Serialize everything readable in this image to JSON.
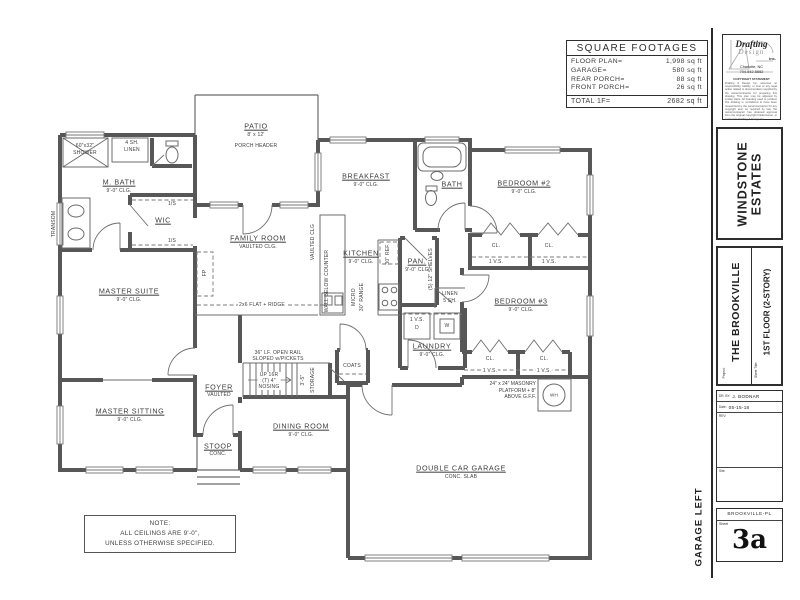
{
  "footages": {
    "title": "SQUARE FOOTAGES",
    "rows": [
      {
        "label": "FLOOR PLAN=",
        "value": "1,998 sq ft"
      },
      {
        "label": "GARAGE=",
        "value": "580 sq ft"
      },
      {
        "label": "REAR PORCH=",
        "value": "88 sq ft"
      },
      {
        "label": "FRONT PORCH=",
        "value": "26 sq ft"
      }
    ],
    "total_label": "TOTAL 1F=",
    "total_value": "2682 sq ft"
  },
  "titleblock": {
    "logo": {
      "name_top": "Drafting",
      "name_mid": "Design",
      "suffix": "Inc.",
      "city": "Charlotte, NC",
      "phone": "704-542-5652",
      "copyright_title": "COPYRIGHT STATEMENT",
      "copyright_text": "Drafting & Design Inc. assumes no responsibility, liability, or cost of any legal action related to documentation supplied by the owner/contractor for preparing this drawing. This plan may be adjusted by similar plans. All branding used to produce this drawing is considered to have been researched by the owner/contractor for any copyright and, as required by law, the owner/contractor has obtained approval from the original copyright holder/owner, or contract to Drafting & Design Inc."
    },
    "subdivision_line1": "WINDSTONE",
    "subdivision_line2": "ESTATES",
    "project_label": "Project:",
    "project_name": "THE BROOKVILLE",
    "sheet_title_label": "Sheet Title:",
    "sheet_title": "1ST FLOOR (2-STORY)",
    "drawn_by_label": "DR. BY:",
    "drawn_by": "J. BODNAR",
    "date_label": "Date:",
    "date_value": "05-15-18",
    "rev_label": "REV:",
    "site_label": "Site:",
    "file_name": "BROOKVILLE-PL",
    "sheet_label": "Sheet",
    "sheet_number": "3a",
    "orientation_note": "GARAGE LEFT"
  },
  "note": {
    "line1": "NOTE:",
    "line2": "ALL CEILINGS ARE 9'-0\",",
    "line3": "UNLESS OTHERWISE SPECIFIED."
  },
  "rooms": {
    "mbath": {
      "name": "M. BATH",
      "clg": "9'-0\" CLG."
    },
    "wic": {
      "name": "WIC"
    },
    "master_suite": {
      "name": "MASTER SUITE",
      "clg": "9'-0\" CLG."
    },
    "master_sitting": {
      "name": "MASTER SITTING",
      "clg": "9'-0\" CLG."
    },
    "patio": {
      "name": "PATIO",
      "size": "8' x 12'",
      "header": "PORCH HEADER"
    },
    "family": {
      "name": "FAMILY ROOM",
      "clg": "VAULTED CLG."
    },
    "breakfast": {
      "name": "BREAKFAST",
      "clg": "9'-0\" CLG."
    },
    "kitchen": {
      "name": "KITCHEN",
      "clg": "9'-0\" CLG."
    },
    "pantry": {
      "name": "PAN.",
      "clg": "9'-0\" CLG"
    },
    "bath": {
      "name": "BATH"
    },
    "bed2": {
      "name": "BEDROOM #2",
      "clg": "9'-0\" CLG."
    },
    "bed3": {
      "name": "BEDROOM #3",
      "clg": "9'-0\" CLG."
    },
    "laundry": {
      "name": "LAUNDRY",
      "clg": "9'-0\" CLG."
    },
    "foyer": {
      "name": "FOYER",
      "clg": "VAULTED"
    },
    "dining": {
      "name": "DINING ROOM",
      "clg": "9'-0\" CLG."
    },
    "stoop": {
      "name": "STOOP",
      "clg": "CONC."
    },
    "garage": {
      "name": "DOUBLE CAR GARAGE",
      "clg": "CONC. SLAB"
    }
  },
  "labels": {
    "shower_size": "60\"x32\"",
    "shower": "SHOWER",
    "linen4_1": "4 SH.",
    "linen4_2": "LINEN",
    "transom": "TRANSOM",
    "shelf_1s": "1/S",
    "ridge": "2x6 FLAT + RIDGE",
    "vaulted": "VAULTED CLG",
    "fireplace": "FP",
    "wall_below": "WALL BELOW COUNTER",
    "ref": "30\" REF.",
    "micro": "MICRO",
    "range": "30\" RANGE",
    "shelves5": "(5) 12\" SHELVES",
    "linen5_1": "LINEN",
    "linen5_2": "5 SH.",
    "vs": "1 V.S.",
    "dryer": "D",
    "washer": "W",
    "cl": "CL.",
    "coats": "COATS",
    "rail_1": "36\" LF. OPEN RAIL",
    "rail_2": "SLOPED w/PICKETS",
    "up": "UP 16R",
    "nosing_1": "(T) 4\"",
    "nosing_2": "NOSING",
    "storage_dim": "3'-5\"",
    "storage": "STORAGE",
    "masonry_1": "24\" x 24\" MASONRY",
    "masonry_2": "PLATFORM + 8\"",
    "masonry_3": "ABOVE G.F.F.",
    "wh": "WH"
  }
}
